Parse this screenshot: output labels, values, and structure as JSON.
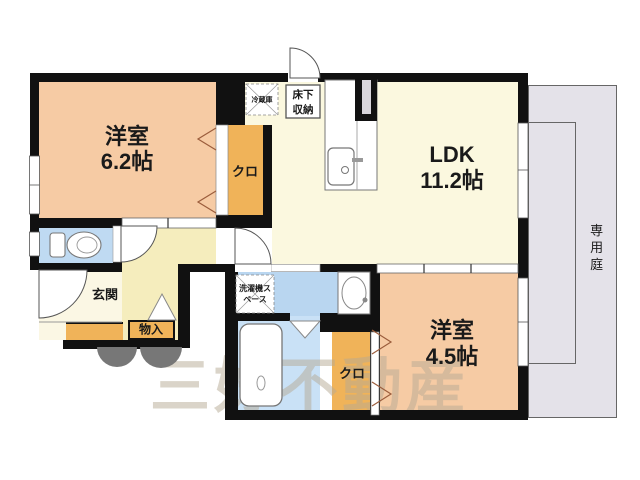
{
  "floorplan": {
    "rooms": {
      "bedroom1": {
        "name": "洋室",
        "size": "6.2帖"
      },
      "ldk": {
        "name": "LDK",
        "size": "11.2帖"
      },
      "bedroom2": {
        "name": "洋室",
        "size": "4.5帖"
      },
      "closet1": {
        "name": "クロ"
      },
      "closet2": {
        "name": "クロ"
      },
      "entrance": {
        "name": "玄関"
      },
      "storage": {
        "name": "物入"
      },
      "garden": {
        "name": "専用庭"
      }
    },
    "fixtures": {
      "underfloor_storage": "床下収納",
      "refrigerator": "冷蔵庫",
      "washer_space": "洗濯機スペース"
    },
    "watermark": "三好不動産",
    "colors": {
      "wall": "#111111",
      "bedroom": "#F6CBA4",
      "closet": "#F0B359",
      "ldk": "#FBF8DF",
      "hallway": "#F5EDBD",
      "entrance": "#FBF7E4",
      "toilet": "#BFDAF2",
      "washroom": "#B9D6F0",
      "bathroom": "#C9E1F6",
      "garden": "#E4E2E9",
      "porch": "#777777"
    }
  }
}
